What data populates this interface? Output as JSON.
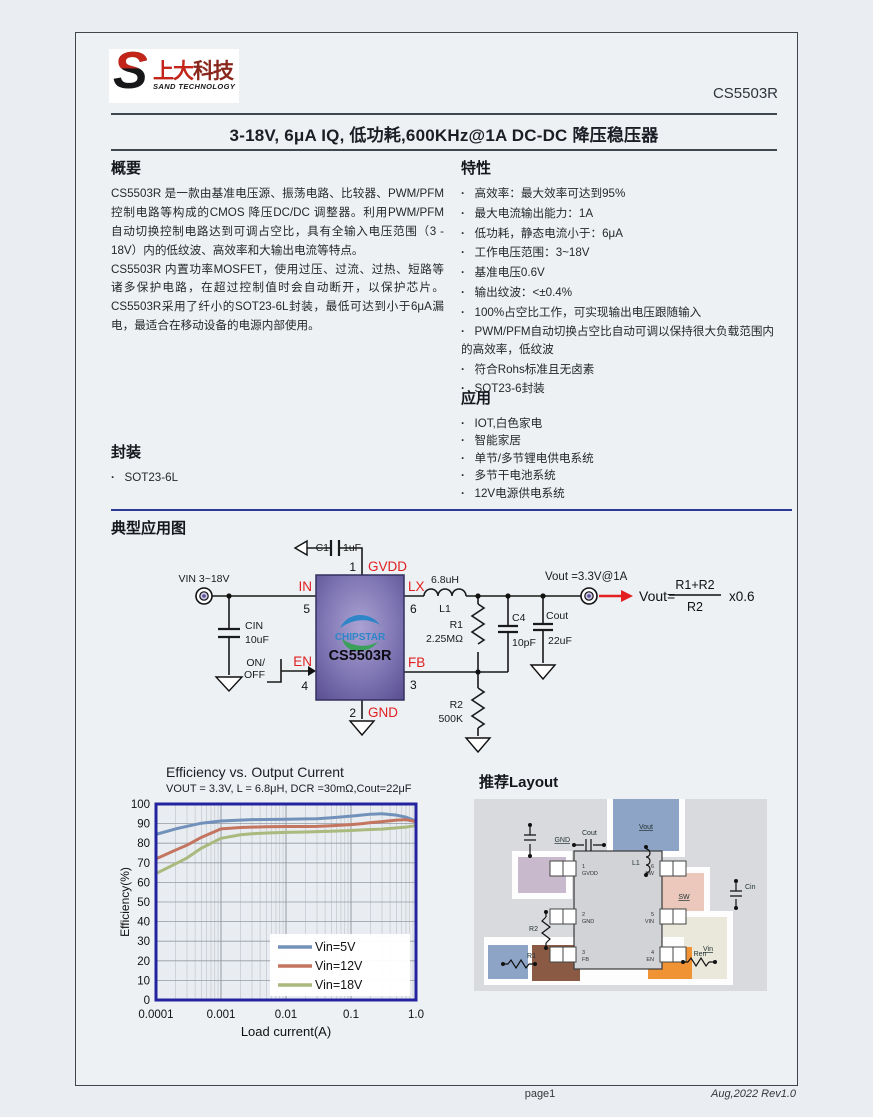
{
  "logo": {
    "glyph": "S",
    "cn_left": "上大",
    "cn_right": "科技",
    "en": "SAND TECHNOLOGY"
  },
  "header": {
    "part_number": "CS5503R",
    "title": "3-18V, 6μA IQ, 低功耗,600KHz@1A DC-DC 降压稳压器"
  },
  "overview": {
    "heading": "概要",
    "p1": "CS5503R 是一款由基准电压源、振荡电路、比较器、PWM/PFM 控制电路等构成的CMOS 降压DC/DC 调整器。利用PWM/PFM 自动切换控制电路达到可调占空比，具有全输入电压范围（3 - 18V）内的低纹波、高效率和大输出电流等特点。",
    "p2": "CS5503R 内置功率MOSFET，使用过压、过流、过热、短路等诸多保护电路，在超过控制值时会自动断开，以保护芯片。CS5503R采用了纤小的SOT23-6L封装，最低可达到小于6μA漏电，最适合在移动设备的电源内部使用。"
  },
  "features": {
    "heading": "特性",
    "items": [
      "高效率：最大效率可达到95%",
      "最大电流输出能力：1A",
      "低功耗，静态电流小于：6μA",
      "工作电压范围：3~18V",
      "基准电压0.6V",
      "输出纹波：<±0.4%",
      "100%占空比工作，可实现输出电压跟随输入",
      "PWM/PFM自动切换占空比自动可调以保持很大负载范围内的高效率，低纹波",
      "符合Rohs标准且无卤素",
      "SOT23-6封装"
    ]
  },
  "applications": {
    "heading": "应用",
    "items": [
      "IOT,白色家电",
      "智能家居",
      "单节/多节锂电供电系统",
      "多节干电池系统",
      "12V电源供电系统"
    ]
  },
  "package": {
    "heading": "封装",
    "items": [
      "SOT23-6L"
    ]
  },
  "typical_app": {
    "heading": "典型应用图",
    "circuit": {
      "vin": "VIN 3~18V",
      "cin": "CIN",
      "cin_val": "10uF",
      "c1": "C1",
      "c1_val": "1uF",
      "on": "ON/",
      "off": "OFF",
      "chip": "CS5503R",
      "chip_logo": "CHIPSTAR",
      "pin_in": "IN",
      "pin_in_n": "5",
      "pin_en": "EN",
      "pin_en_n": "4",
      "pin_gnd": "GND",
      "pin_gnd_n": "2",
      "pin_gvdd": "GVDD",
      "pin_gvdd_n": "1",
      "pin_lx": "LX",
      "pin_lx_n": "6",
      "pin_fb": "FB",
      "pin_fb_n": "3",
      "l1": "L1",
      "l1_val": "6.8uH",
      "r1": "R1",
      "r1_val": "2.25MΩ",
      "c4": "C4",
      "c4_val": "10pF",
      "cout": "Cout",
      "cout_val": "22uF",
      "r2": "R2",
      "r2_val": "500K",
      "vout": "Vout =3.3V@1A",
      "f_lhs": "Vout=",
      "f_num": "R1+R2",
      "f_den": "R2",
      "f_mul": "x0.6"
    }
  },
  "chart_data": {
    "type": "line",
    "title": "Efficiency vs. Output Current",
    "subtitle": "VOUT = 3.3V, L = 6.8μH, DCR =30mΩ,Cout=22μF",
    "xlabel": "Load current(A)",
    "ylabel": "Efficiency(%)",
    "x_scale": "log",
    "xlim": [
      0.0001,
      1.0
    ],
    "ylim": [
      0,
      100
    ],
    "grid": true,
    "legend_position": "lower right",
    "x_ticks": [
      0.0001,
      0.001,
      0.01,
      0.1,
      1.0
    ],
    "x_tick_labels": [
      "0.0001",
      "0.001",
      "0.01",
      "0.1",
      "1.0"
    ],
    "y_ticks": [
      0,
      10,
      20,
      30,
      40,
      50,
      60,
      70,
      80,
      90,
      100
    ],
    "x": [
      0.0001,
      0.0002,
      0.0003,
      0.0005,
      0.001,
      0.002,
      0.003,
      0.005,
      0.01,
      0.02,
      0.03,
      0.05,
      0.1,
      0.15,
      0.2,
      0.3,
      0.5,
      0.7,
      1.0
    ],
    "series": [
      {
        "name": "Vin=5V",
        "color": "#7291ba",
        "values": [
          84.5,
          87.3,
          88.6,
          90.2,
          91.3,
          91.8,
          92.0,
          92.1,
          92.2,
          92.4,
          92.5,
          93.0,
          93.8,
          94.4,
          94.8,
          95.0,
          94.3,
          93.3,
          91.3
        ]
      },
      {
        "name": "Vin=12V",
        "color": "#c47560",
        "values": [
          72.0,
          76.5,
          79.0,
          83.0,
          87.3,
          88.0,
          88.2,
          88.4,
          88.5,
          88.5,
          88.6,
          88.9,
          89.5,
          90.0,
          90.5,
          91.0,
          91.8,
          92.0,
          91.0
        ]
      },
      {
        "name": "Vin=18V",
        "color": "#aab97e",
        "values": [
          64.5,
          69.5,
          72.5,
          77.5,
          82.5,
          84.3,
          84.8,
          85.2,
          85.5,
          85.7,
          85.9,
          86.1,
          86.5,
          86.8,
          87.0,
          87.2,
          87.8,
          88.2,
          89.0
        ]
      }
    ]
  },
  "layout": {
    "heading": "推荐Layout",
    "nets": {
      "vout": "Vout",
      "gnd": "GND",
      "cout": "Cout",
      "l1": "L1",
      "sw": "SW",
      "cin": "Cin",
      "vin": "Vin",
      "ren": "Ren",
      "r2": "R2",
      "r1": "R1"
    },
    "pins": {
      "p1": "1",
      "p1n": "GVDD",
      "p2": "2",
      "p2n": "GND",
      "p3": "3",
      "p3n": "FB",
      "p6": "6",
      "p6n": "SW",
      "p5": "5",
      "p5n": "VIN",
      "p4": "4",
      "p4n": "EN"
    }
  },
  "footer": {
    "page": "page1",
    "rev": "Aug,2022  Rev1.0"
  }
}
